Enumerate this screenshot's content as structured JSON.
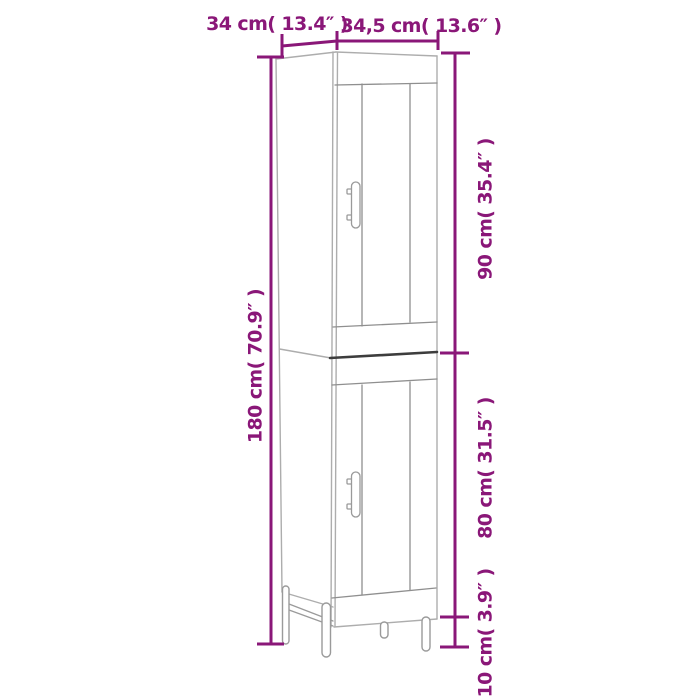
{
  "colors": {
    "dimension": "#8a1778",
    "background": "#ffffff"
  },
  "labels": {
    "top_depth": "34 cm( 13.4″ )",
    "top_width": "34,5 cm( 13.6″ )",
    "left_height": "180 cm( 70.9″ )",
    "right_upper_height": "90 cm( 35.4″ )",
    "right_lower_height": "80 cm( 31.5″ )",
    "right_leg_height": "10 cm( 3.9″ )"
  }
}
